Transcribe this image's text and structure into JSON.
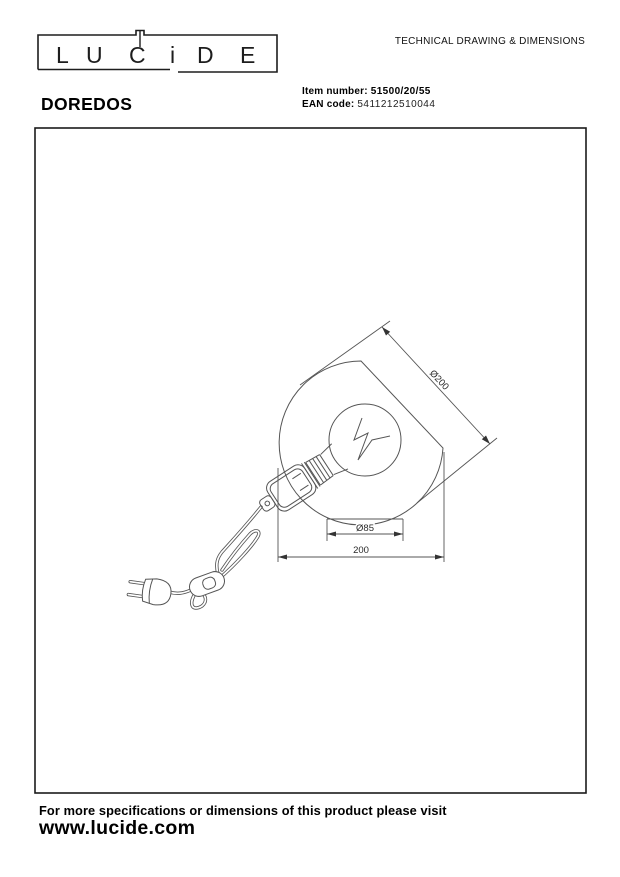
{
  "brand": {
    "name": "LUCiDE",
    "letters": [
      "L",
      "U",
      "C",
      "i",
      "D",
      "E"
    ]
  },
  "header": {
    "doc_title": "TECHNICAL DRAWING & DIMENSIONS",
    "product_name": "DOREDOS",
    "item_number_label": "Item number:",
    "item_number_value": "51500/20/55",
    "ean_label": "EAN code:",
    "ean_value": "5411212510044"
  },
  "drawing": {
    "dim_shade_diameter": "Ø200",
    "dim_base_diameter": "Ø85",
    "dim_total_width": "200"
  },
  "footer": {
    "note": "For more specifications or dimensions of this product please visit",
    "website": "www.lucide.com"
  },
  "colors": {
    "line": "#555555",
    "text": "#1a1a1a",
    "frame": "#1a1a1a"
  }
}
